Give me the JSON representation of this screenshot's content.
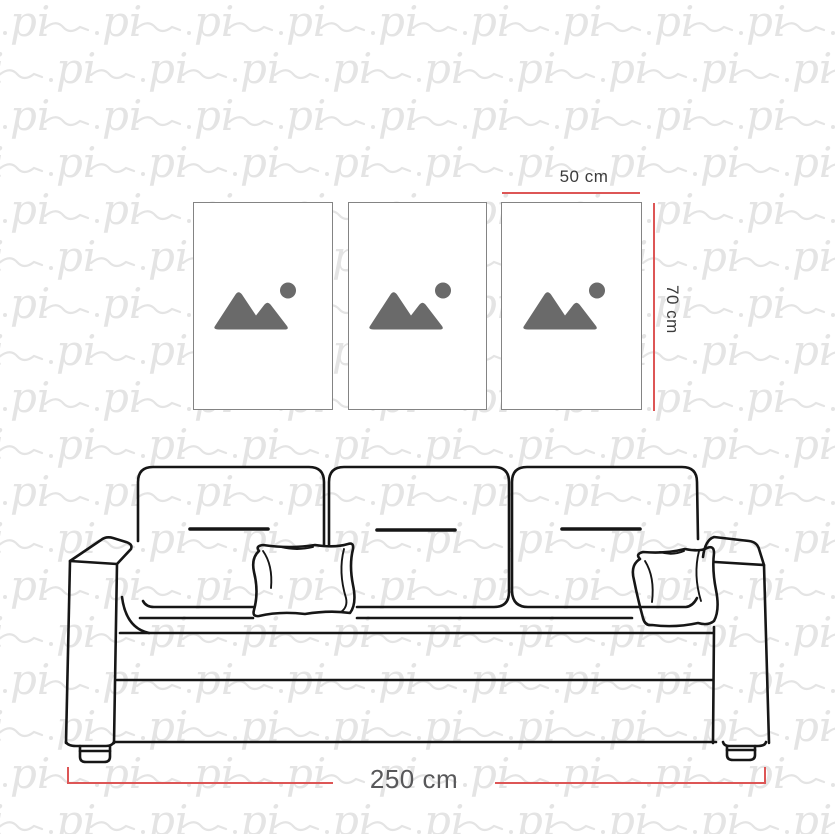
{
  "scene": {
    "description": "Sofa with three wall frames dimension mockup",
    "frame_count": 3
  },
  "watermark": {
    "text": "pi",
    "color": "#e4e4e4"
  },
  "dimensions": {
    "frame_width": {
      "label": "50 cm"
    },
    "frame_height": {
      "label": "70 cm"
    },
    "sofa_width": {
      "label": "250 cm"
    }
  },
  "colors": {
    "c-red": "#dd5656",
    "c-label-dark": "#3b3b3b",
    "c-label-gray": "#58585a",
    "c-sofa": "#161616",
    "c-frame-border": "#848484",
    "c-icon": "#6a6a6a",
    "c-wm": "#e4e4e4",
    "c-bg": "#ffffff"
  }
}
